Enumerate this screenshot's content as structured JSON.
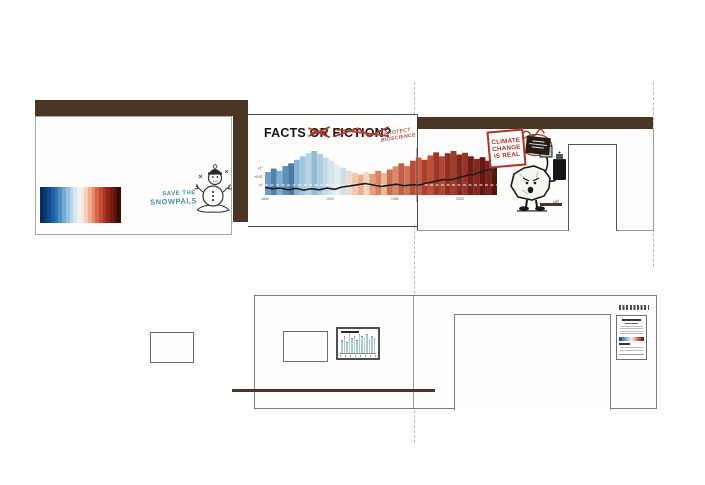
{
  "panel_left": {
    "snowpals_line1": "SAVE THE",
    "snowpals_line2": "SNOWPALS",
    "stripe_colors": [
      "#0a2e5c",
      "#0c3a74",
      "#10498c",
      "#1f5fa5",
      "#2f74b3",
      "#4b8fc4",
      "#72aad2",
      "#97c2de",
      "#b9d5e8",
      "#d7e6f0",
      "#edf2f5",
      "#f8e9e1",
      "#f6cdb9",
      "#f0ab8d",
      "#e68768",
      "#d96448",
      "#c44a33",
      "#ad3423",
      "#92251a",
      "#741b12",
      "#57120c",
      "#3a0a07"
    ]
  },
  "panel_facts": {
    "headline_kept": "FACTS ",
    "headline_crossed": "OR FICTION?",
    "protect_line1": "PROTECT",
    "protect_line2": "BIOSCIENCE"
  },
  "panel_character": {
    "sign_line1": "CLIMATE",
    "sign_line2": "CHANGE",
    "sign_line3": "IS REAL",
    "signature": "gbl"
  },
  "chart_data": [
    {
      "type": "bar",
      "subtype": "warming-stripes-mural-with-anomaly-line",
      "title": "FACTS OR FICTION?",
      "xticks": [
        "1880",
        "1920",
        "1960",
        "2000"
      ],
      "xtick_fractions": [
        0.0,
        0.28,
        0.56,
        0.84
      ],
      "yticks": [
        {
          "label": "+1°",
          "value": 1.0
        },
        {
          "label": "+0.5°",
          "value": 0.5
        },
        {
          "label": "0°",
          "value": 0.0
        }
      ],
      "baseline_value": 0,
      "stripe_colors": [
        "#6f9dc4",
        "#537fa8",
        "#7fb0d2",
        "#628fb8",
        "#4a7aa6",
        "#86b3d4",
        "#a2c5dd",
        "#b8d2e4",
        "#93bcd8",
        "#aecbe0",
        "#c6dbea",
        "#d6e5ef",
        "#e4eef4",
        "#cfdfe9",
        "#f0dccf",
        "#f2c8ae",
        "#eaac8d",
        "#f4d5c2",
        "#e49e7e",
        "#dc8262",
        "#ecb79c",
        "#cc6d51",
        "#d8886c",
        "#c25c44",
        "#d27557",
        "#bc4c38",
        "#c86148",
        "#ab3e2e",
        "#bb513b",
        "#a03727",
        "#b04634",
        "#922f22",
        "#a23c2a",
        "#80281d",
        "#96342a",
        "#701f16",
        "#88291f",
        "#601a13",
        "#7a2318",
        "#521508"
      ],
      "stripe_heights": [
        0.52,
        0.6,
        0.55,
        0.66,
        0.72,
        0.8,
        0.88,
        0.95,
        1.0,
        0.93,
        0.85,
        0.78,
        0.7,
        0.62,
        0.55,
        0.5,
        0.46,
        0.52,
        0.48,
        0.55,
        0.5,
        0.58,
        0.65,
        0.72,
        0.66,
        0.78,
        0.85,
        0.8,
        0.9,
        0.97,
        0.88,
        0.95,
        1.0,
        0.92,
        0.96,
        0.88,
        0.82,
        0.86,
        0.78,
        0.7
      ],
      "line_series": {
        "name": "global temperature anomaly (°C)",
        "values": [
          -0.15,
          -0.22,
          -0.18,
          -0.28,
          -0.2,
          -0.3,
          -0.22,
          -0.28,
          -0.18,
          -0.25,
          -0.12,
          -0.05,
          0.02,
          0.08,
          0.0,
          -0.08,
          -0.02,
          0.04,
          -0.04,
          0.02,
          0.0,
          0.12,
          0.22,
          0.32,
          0.3,
          0.42,
          0.55,
          0.62,
          0.78,
          0.92,
          1.02
        ]
      }
    },
    {
      "type": "bar",
      "title": "",
      "values": [
        6,
        8,
        5,
        9,
        7,
        8,
        6,
        9,
        8,
        7,
        9,
        6,
        8,
        7
      ],
      "color": "#a9c9cd"
    }
  ],
  "colors": {
    "brown": "#4a3425",
    "red_accent": "#a83525",
    "teal_text": "#4e8fa0",
    "dash_gray": "#bbbbbb",
    "poster_gradient": [
      "#1a3a6b",
      "#6fa7d4",
      "#f5f1ec",
      "#d96a4a",
      "#5c0a0d"
    ]
  }
}
